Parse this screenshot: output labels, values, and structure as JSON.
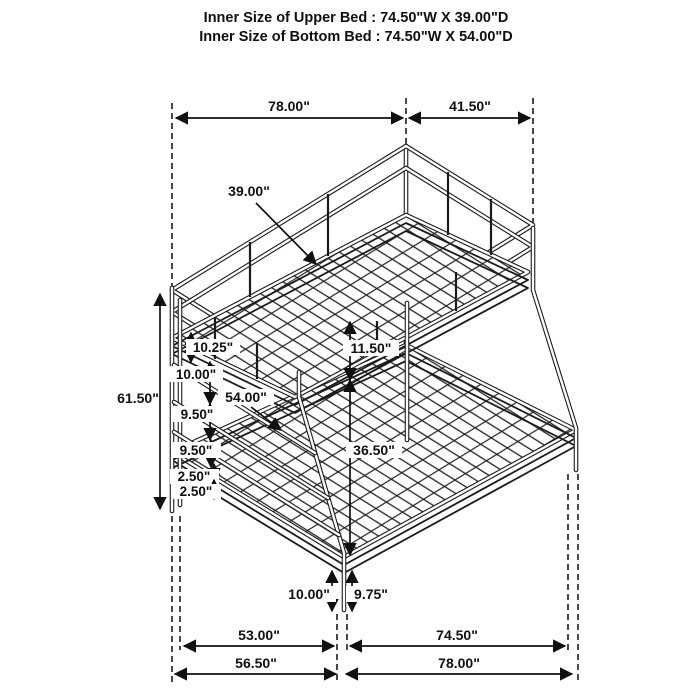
{
  "page": {
    "background": "#ffffff",
    "line_color": "#1b1b1b"
  },
  "header": {
    "line1": "Inner Size of Upper Bed : 74.50\"W X 39.00\"D",
    "line2": "Inner Size of Bottom Bed : 74.50\"W X 54.00\"D"
  },
  "dims": {
    "top_width": "78.00\"",
    "top_depth": "41.50\"",
    "upper_bed_depth": "39.00\"",
    "overall_height": "61.50\"",
    "upper_frame_band": "10.25\"",
    "ladder_gap_top": "10.00\"",
    "ladder_gap_mid": "9.50\"",
    "ladder_gap_low": "9.50\"",
    "frame_gap_a": "2.50\"",
    "frame_gap_b": "2.50\"",
    "bunk_gap": "11.50\"",
    "lower_bed_depth": "54.00\"",
    "under_clearance": "36.50\"",
    "front_leg_outer": "10.00\"",
    "front_leg_inner": "9.75\"",
    "base_inner_depth": "53.00\"",
    "base_inner_width": "74.50\"",
    "base_outer_depth": "56.50\"",
    "base_outer_width": "78.00\""
  }
}
